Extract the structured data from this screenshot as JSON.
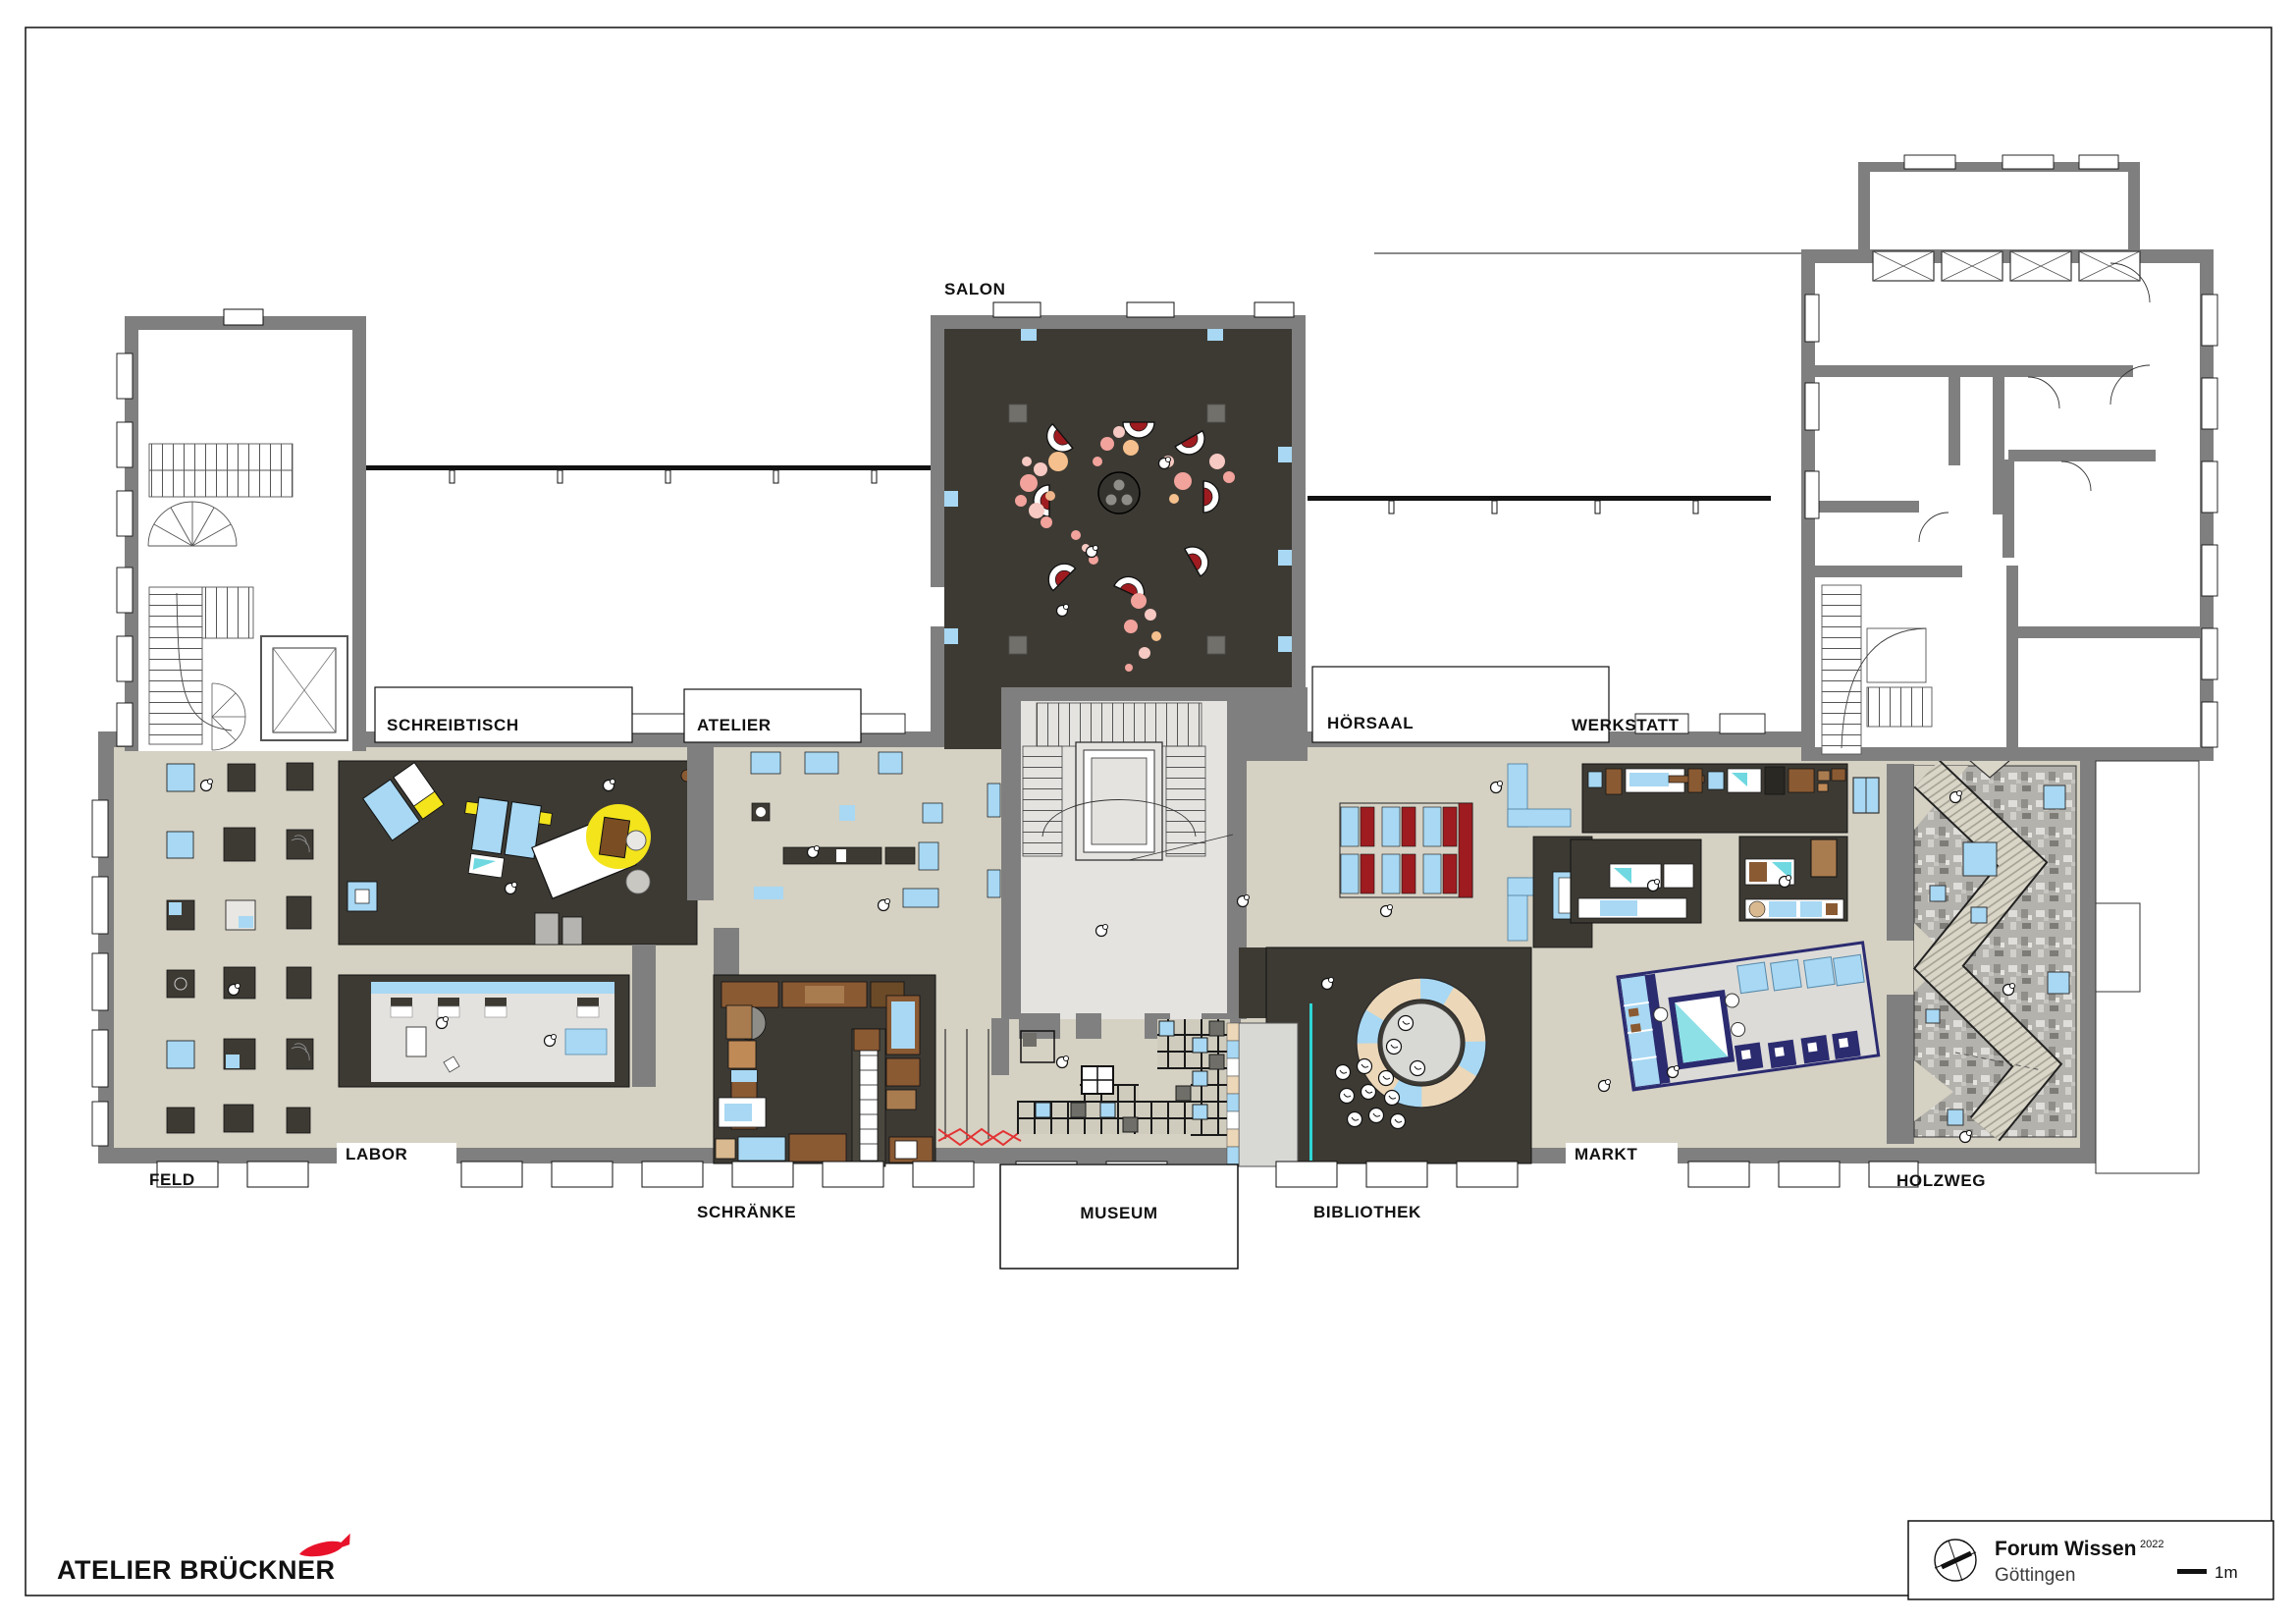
{
  "room_labels": {
    "salon": "SALON",
    "schreibtisch": "SCHREIBTISCH",
    "atelier": "ATELIER",
    "hoersaal": "HÖRSAAL",
    "werkstatt": "WERKSTATT",
    "feld": "FELD",
    "labor": "LABOR",
    "schraenke": "SCHRÄNKE",
    "museum": "MUSEUM",
    "bibliothek": "BIBLIOTHEK",
    "markt": "MARKT",
    "holzweg": "HOLZWEG"
  },
  "footer": {
    "logo": "ATELIER BRÜCKNER"
  },
  "title_block": {
    "project": "Forum Wissen",
    "year": "2022",
    "city": "Göttingen",
    "scale_label": "1m"
  },
  "colors": {
    "wall_gray": "#7f7f7f",
    "floor_beige": "#d5d1c3",
    "floor_light": "#e4e3e0",
    "dark_room": "#3d3a34",
    "accent_blue": "#a8d8f3",
    "accent_red": "#9e1c20",
    "accent_yellow": "#f3e41c",
    "accent_navy": "#2b2b70",
    "accent_tan": "#ecd7b8",
    "accent_cyan": "#2fd6d6",
    "accent_pink": "#f2a39c",
    "logo_red": "#e8132b",
    "wood_brown": "#8a5a33"
  },
  "icons": {
    "compass": "compass-icon",
    "fish": "fish-logo-icon",
    "scale_bar": "scale-bar"
  }
}
